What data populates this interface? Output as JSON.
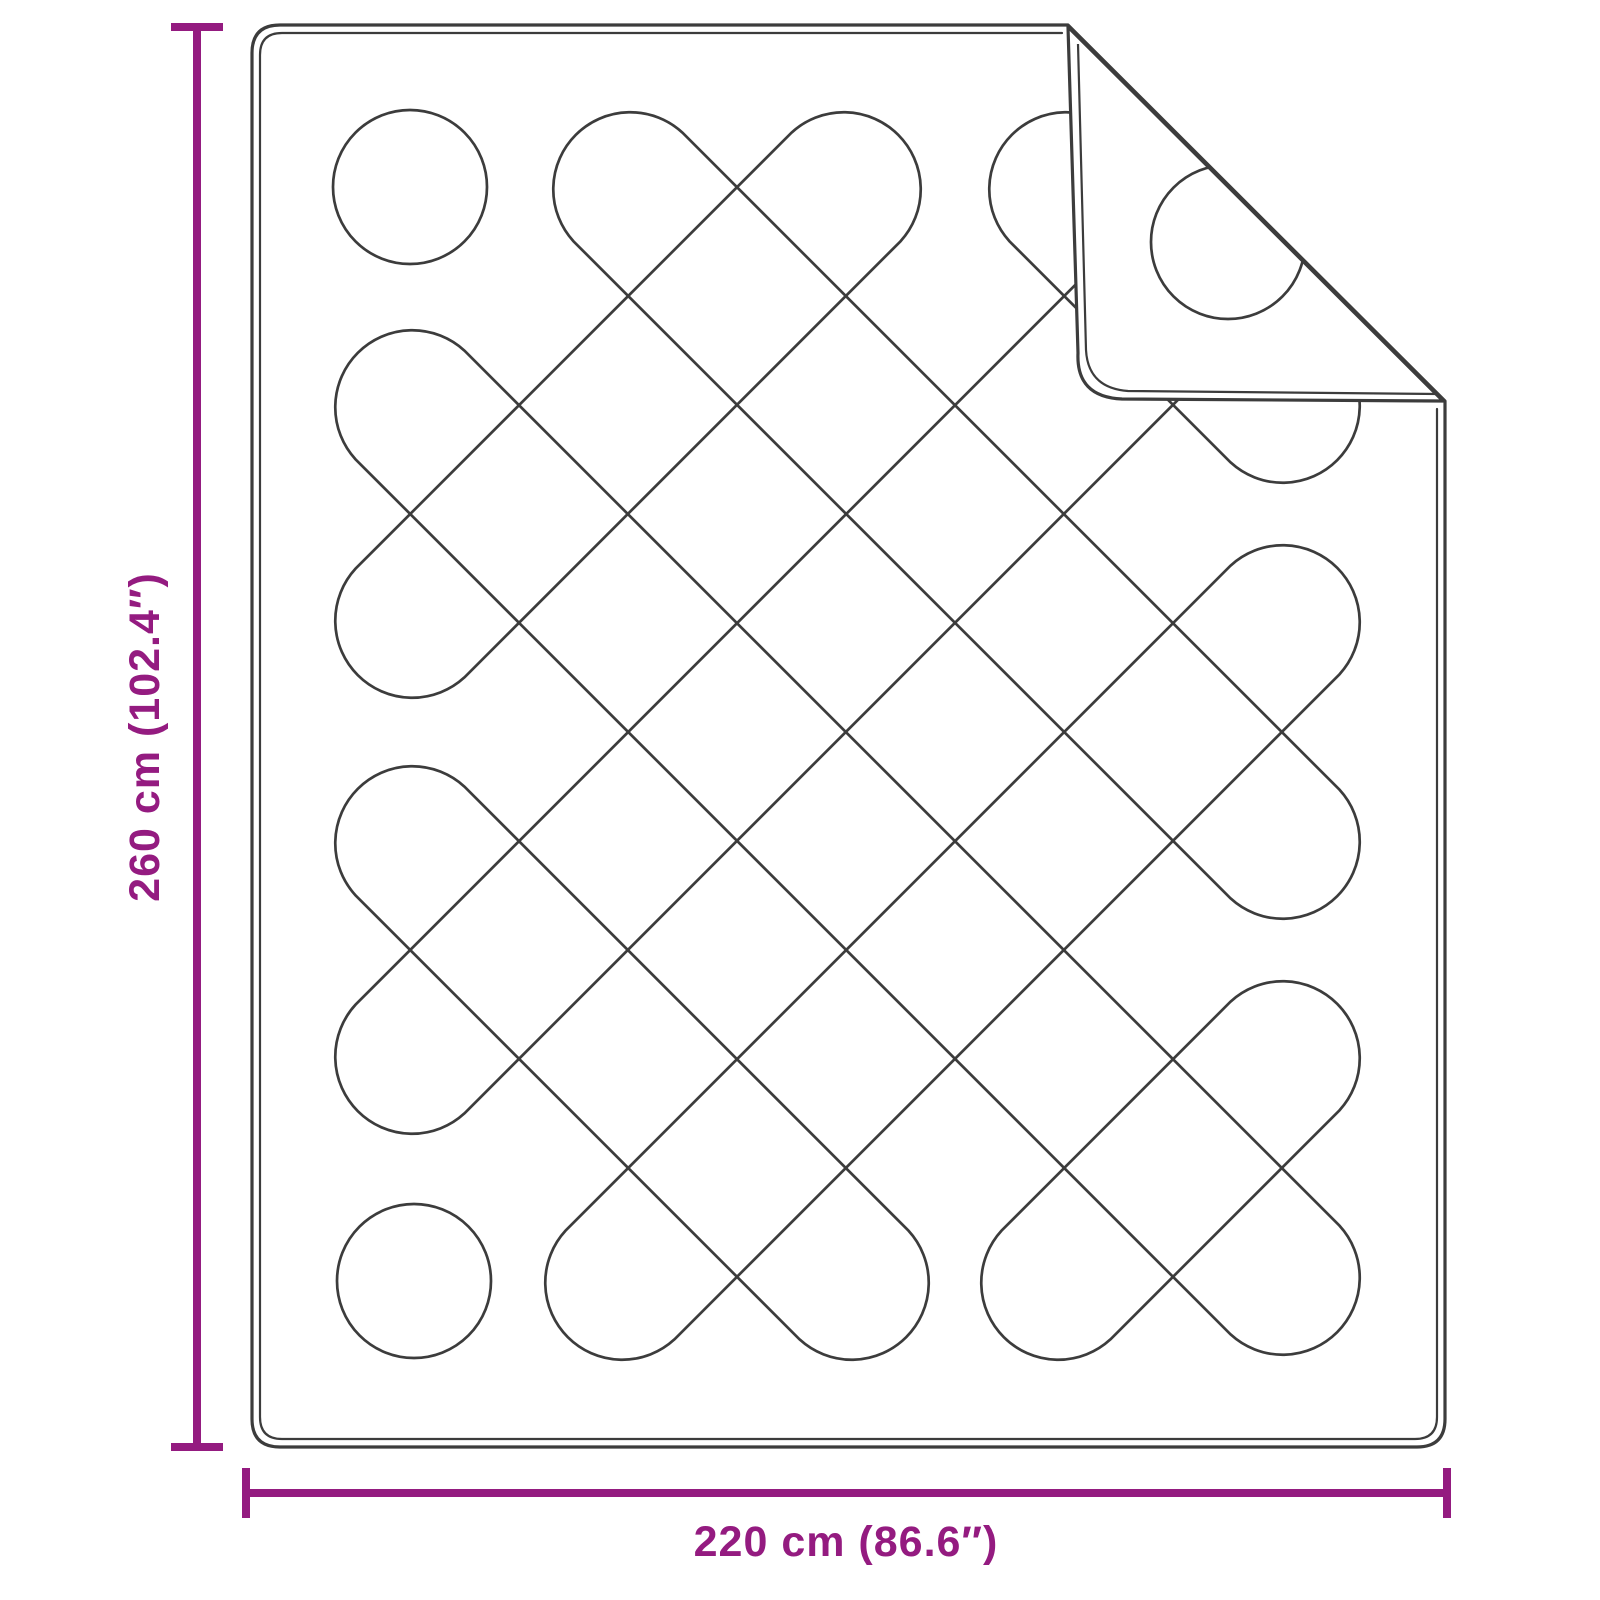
{
  "page": {
    "background": "#FFFFFF",
    "width": 1600,
    "height": 1600
  },
  "diagram": {
    "type": "product-dimension-diagram",
    "subject": "quilted-blanket-with-folded-top-right-corner",
    "colors": {
      "outline": "#3C3C3C",
      "accent": "#941B80",
      "blanket_fill": "#FFFFFF"
    },
    "dimension_height": {
      "label": "260 cm (102.4″)",
      "value_cm": "260 cm",
      "value_inch": "102.4″"
    },
    "dimension_width": {
      "label": "220 cm (86.6″)",
      "value_cm": "220 cm",
      "value_inch": "86.6″"
    },
    "geometry": {
      "blanket": {
        "left": 252,
        "top": 25,
        "right": 1445,
        "bottom": 1447,
        "corner_radius": 28,
        "border_inset": 8
      },
      "crease": {
        "x1": 1068,
        "y1": 25,
        "x2": 1445,
        "y2": 401
      },
      "flap": {
        "outline": "M 1068,27 L 1443,401 L 1122,399 Q 1076,397 1078,353 Z",
        "inner_line": "M 1078,44 L 1086,350 Q 1088,388 1128,391 L 1438,394",
        "circle": {
          "cx": 1228,
          "cy": 242,
          "r": 77
        }
      },
      "pattern": {
        "capsule_radius": 77,
        "safe_rect": {
          "x1": 410,
          "y1": 187,
          "x2": 1285,
          "y2": 1285
        },
        "ne_axes": [
          597,
          1033,
          1469,
          1905,
          2341
        ],
        "se_axes": [
          -877,
          -441,
          -5,
          431,
          867
        ]
      },
      "dim_v": {
        "x": 197,
        "y1": 27,
        "y2": 1447,
        "cap_half": 26,
        "label_x": 145,
        "label_y": 737
      },
      "dim_h": {
        "y": 1493,
        "x1": 246,
        "x2": 1447,
        "cap_half": 25,
        "label_x": 846,
        "label_y": 1556
      },
      "stroke": {
        "outer": 3.2,
        "inner": 2.2,
        "pattern": 2.7,
        "dim": 8
      }
    }
  }
}
